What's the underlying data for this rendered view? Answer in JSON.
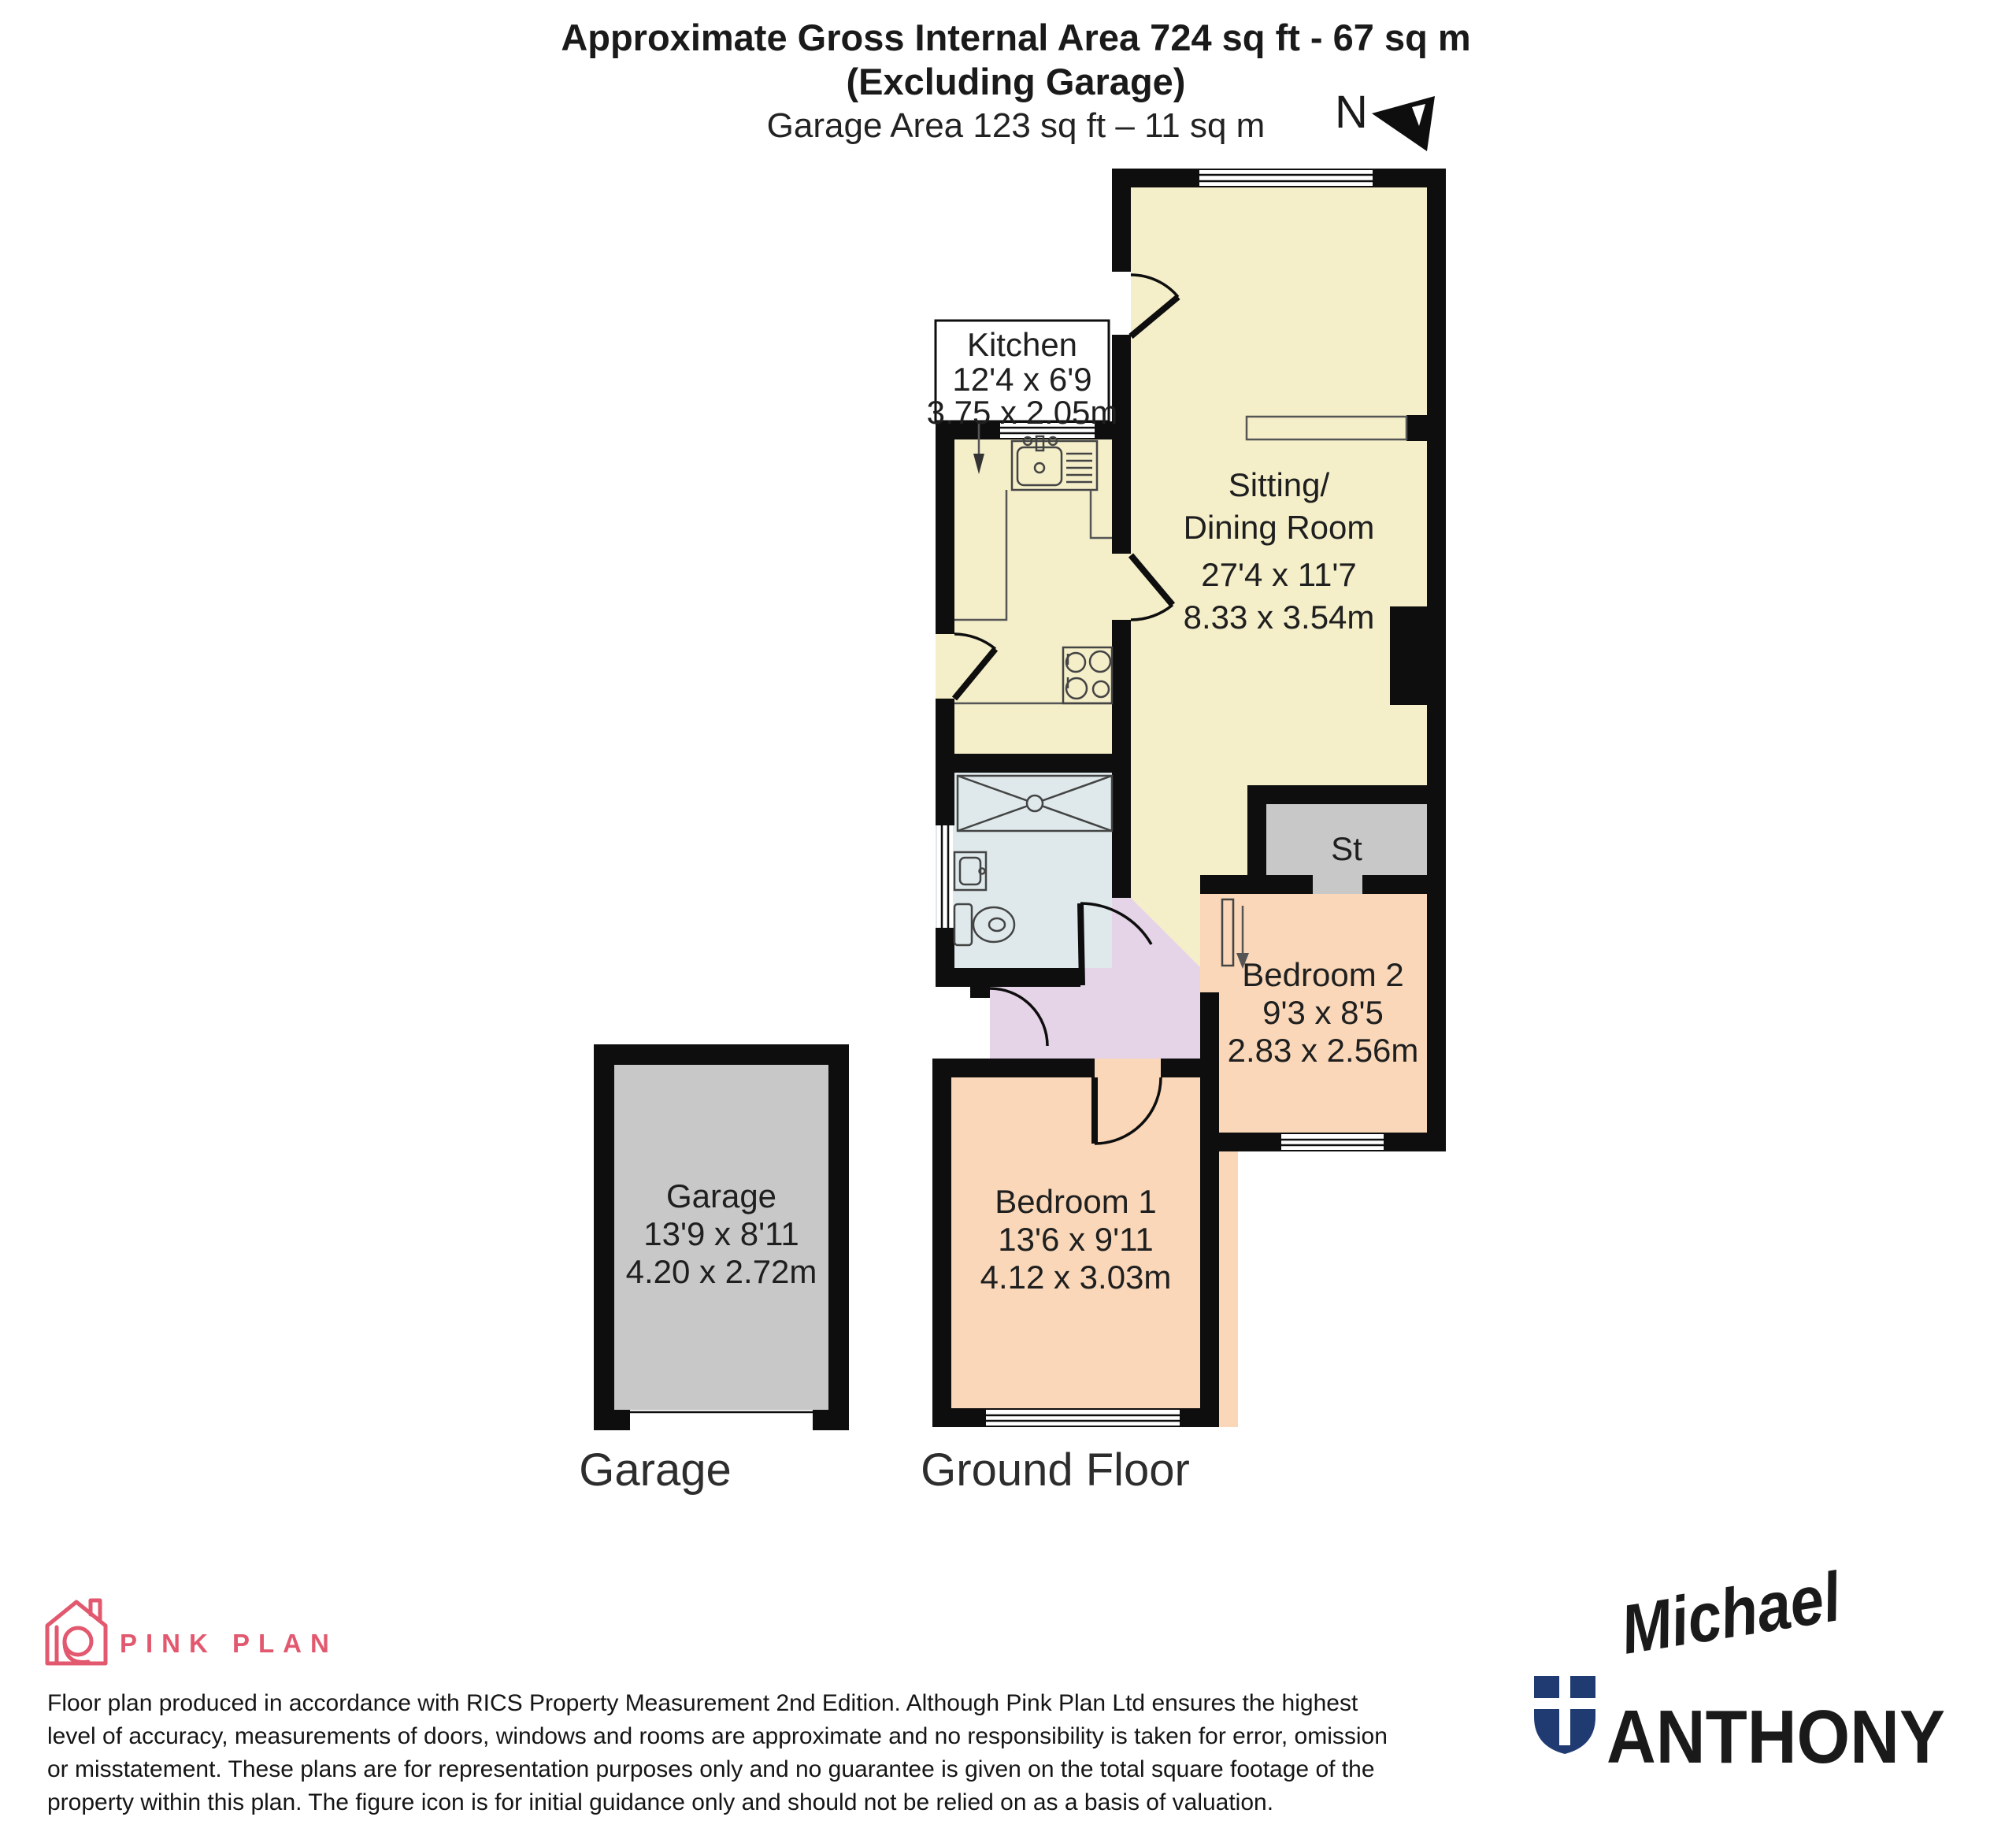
{
  "title": {
    "line1": "Approximate Gross Internal Area 724 sq ft - 67 sq m",
    "line2": "(Excluding Garage)",
    "line3": "Garage Area 123 sq ft – 11 sq m"
  },
  "compass": {
    "north_label": "N"
  },
  "rooms": {
    "kitchen": {
      "name": "Kitchen",
      "dims_imperial": "12'4 x 6'9",
      "dims_metric": "3.75 x 2.05m"
    },
    "sitting_dining": {
      "name_line1": "Sitting/",
      "name_line2": "Dining Room",
      "dims_imperial": "27'4 x 11'7",
      "dims_metric": "8.33 x 3.54m"
    },
    "bedroom1": {
      "name": "Bedroom 1",
      "dims_imperial": "13'6 x 9'11",
      "dims_metric": "4.12 x 3.03m"
    },
    "bedroom2": {
      "name": "Bedroom 2",
      "dims_imperial": "9'3 x 8'5",
      "dims_metric": "2.83 x 2.56m"
    },
    "storage": {
      "name": "St"
    },
    "garage": {
      "name": "Garage",
      "dims_imperial": "13'9 x 8'11",
      "dims_metric": "4.20 x 2.72m"
    }
  },
  "captions": {
    "garage": "Garage",
    "ground_floor": "Ground Floor"
  },
  "branding": {
    "producer": "PINK PLAN",
    "agent_script": "Michael",
    "agent_caps": "ANTHONY"
  },
  "disclaimer": {
    "line1": "Floor plan produced in accordance with RICS Property Measurement 2nd Edition. Although Pink Plan Ltd ensures the highest",
    "line2": "level of accuracy, measurements of doors, windows and rooms are approximate and no responsibility is taken for error, omission",
    "line3": "or misstatement. These plans are for representation purposes only and no guarantee is given on the total square footage of the",
    "line4": "property within this plan. The figure icon is for initial guidance only and should not be relied on as a basis of valuation."
  },
  "colors": {
    "room_cream": "#F4EEC9",
    "room_peach": "#F9D7B8",
    "room_lavender": "#E5D3E7",
    "room_blue": "#DFE9EB",
    "room_gray": "#C8C8C8",
    "wall": "#0E0E0E",
    "producer_pink": "#E2596F",
    "agent_red": "#D2232A",
    "agent_navy": "#203B72"
  }
}
